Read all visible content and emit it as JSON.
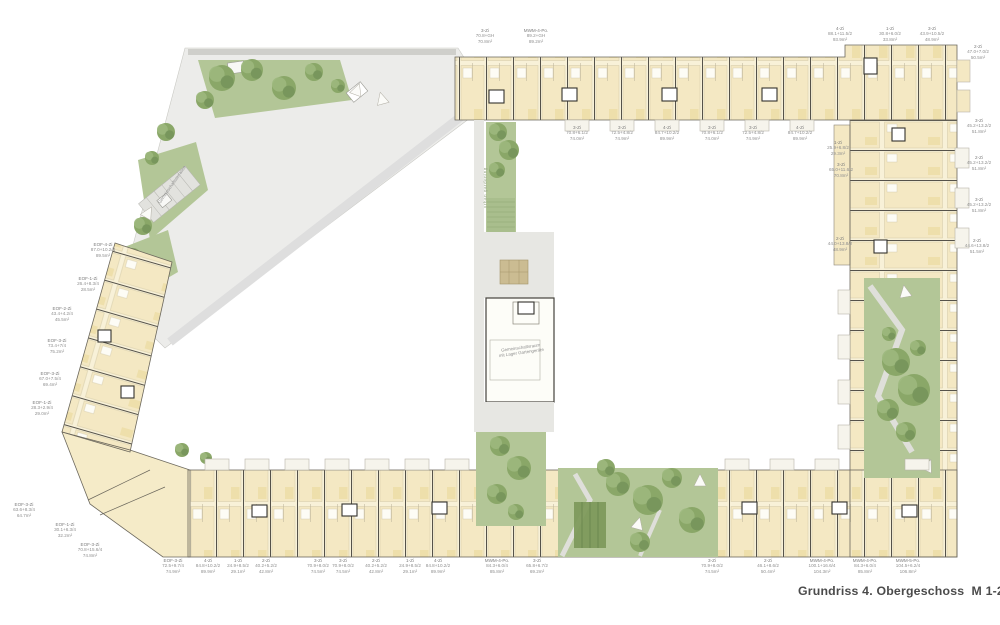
{
  "title": "Grundriss 4. Obergeschoss  M 1-200",
  "colors": {
    "building": "#f8f1d8",
    "unit": "#f4e8c3",
    "wall": "#55524a",
    "path_gray": "#e7e7e3",
    "green": "#b3c697",
    "tree": "#8aa768",
    "label": "#8f8f8f",
    "title_text": "#4b4b4b"
  },
  "annotations": {
    "urban_gardening": "urban gardening",
    "community_room_line1": "Gemeinschaftsraum",
    "community_room_line2": "mit Lager Gartengeräte",
    "terrace": "Gemeinschaftsterrasse"
  },
  "units": [
    {
      "x": 485,
      "y": 28,
      "type": "3-Zi",
      "calc": "70.8+GH",
      "area": "70.8m²"
    },
    {
      "x": 536,
      "y": 28,
      "type": "MWM-4-Po.",
      "calc": "89.2+GH",
      "area": "89.2m²"
    },
    {
      "x": 840,
      "y": 26,
      "type": "4-Zi",
      "calc": "88.1+11.5/2",
      "area": "93.9m²"
    },
    {
      "x": 890,
      "y": 26,
      "type": "1-Zi",
      "calc": "30.8+6.0/2",
      "area": "33.8m²"
    },
    {
      "x": 932,
      "y": 26,
      "type": "3-Zi",
      "calc": "43.9+10.5/2",
      "area": "48.9m²"
    },
    {
      "x": 978,
      "y": 44,
      "type": "2-Zi",
      "calc": "47.0+7.0/2",
      "area": "50.5m²"
    },
    {
      "x": 577,
      "y": 125,
      "type": "3-Zi",
      "calc": "70.8+6.1/2",
      "area": "74.0m²"
    },
    {
      "x": 622,
      "y": 125,
      "type": "3-Zi",
      "calc": "72.5+4.8/2",
      "area": "74.9m²"
    },
    {
      "x": 667,
      "y": 125,
      "type": "4-Zi",
      "calc": "84.7+10.2/2",
      "area": "89.9m²"
    },
    {
      "x": 712,
      "y": 125,
      "type": "3-Zi",
      "calc": "70.8+6.1/2",
      "area": "74.0m²"
    },
    {
      "x": 753,
      "y": 125,
      "type": "3-Zi",
      "calc": "72.5+4.8/2",
      "area": "74.9m²"
    },
    {
      "x": 800,
      "y": 125,
      "type": "4-Zi",
      "calc": "84.7+10.2/2",
      "area": "89.9m²"
    },
    {
      "x": 838,
      "y": 140,
      "type": "1-Zi",
      "calc": "25.9+6.8/2",
      "area": "29.3m²"
    },
    {
      "x": 841,
      "y": 162,
      "type": "3-Zi",
      "calc": "65.0+11.6/2",
      "area": "70.8m²"
    },
    {
      "x": 840,
      "y": 236,
      "type": "2-Zi",
      "calc": "44.0+13.8/2",
      "area": "48.9m²"
    },
    {
      "x": 979,
      "y": 118,
      "type": "3-Zi",
      "calc": "45.2+13.2/2",
      "area": "51.8m²"
    },
    {
      "x": 979,
      "y": 155,
      "type": "2-Zi",
      "calc": "45.2+13.2/2",
      "area": "51.8m²"
    },
    {
      "x": 979,
      "y": 197,
      "type": "3-Zi",
      "calc": "45.2+13.2/2",
      "area": "51.8m²"
    },
    {
      "x": 977,
      "y": 238,
      "type": "2-Zi",
      "calc": "44.6+13.8/2",
      "area": "51.5m²"
    },
    {
      "x": 103,
      "y": 242,
      "type": "EOF-4-Zi",
      "calc": "87.0+10.2/4",
      "area": "89.5m²"
    },
    {
      "x": 88,
      "y": 276,
      "type": "EOF-1-Zi",
      "calc": "26.4+8.3/4",
      "area": "28.5m²"
    },
    {
      "x": 62,
      "y": 306,
      "type": "EOF-2-Zi",
      "calc": "43.4+4.2/4",
      "area": "45.5m²"
    },
    {
      "x": 57,
      "y": 338,
      "type": "EOF-3-Zi",
      "calc": "73.4+7/4",
      "area": "75.2m²"
    },
    {
      "x": 50,
      "y": 371,
      "type": "EOF-3-Zi",
      "calc": "67.0+7.5/4",
      "area": "69.4m²"
    },
    {
      "x": 42,
      "y": 400,
      "type": "EOF-1-Zi",
      "calc": "28.3+2.9/4",
      "area": "29.0m²"
    },
    {
      "x": 24,
      "y": 502,
      "type": "EOF-3-Zi",
      "calc": "63.6+8.3/4",
      "area": "64.7m²"
    },
    {
      "x": 65,
      "y": 522,
      "type": "EOF-1-Zi",
      "calc": "30.1+6.3/4",
      "area": "32.2m²"
    },
    {
      "x": 90,
      "y": 542,
      "type": "EOF-3-Zi",
      "calc": "70.8+15.6/4",
      "area": "74.8m²"
    },
    {
      "x": 173,
      "y": 558,
      "type": "EOF-3-Zi",
      "calc": "72.5+9.7/4",
      "area": "74.9m²"
    },
    {
      "x": 208,
      "y": 558,
      "type": "4-Zi",
      "calc": "84.8+10.2/2",
      "area": "89.9m²"
    },
    {
      "x": 238,
      "y": 558,
      "type": "1-Zi",
      "calc": "24.9+8.5/2",
      "area": "29.1m²"
    },
    {
      "x": 266,
      "y": 558,
      "type": "2-Zi",
      "calc": "40.2+5.2/2",
      "area": "42.8m²"
    },
    {
      "x": 318,
      "y": 558,
      "type": "3-Zi",
      "calc": "70.9+8.0/2",
      "area": "74.5m²"
    },
    {
      "x": 343,
      "y": 558,
      "type": "3-Zi",
      "calc": "70.9+8.0/2",
      "area": "74.5m²"
    },
    {
      "x": 376,
      "y": 558,
      "type": "2-Zi",
      "calc": "40.2+5.2/2",
      "area": "42.8m²"
    },
    {
      "x": 410,
      "y": 558,
      "type": "1-Zi",
      "calc": "24.9+8.5/2",
      "area": "29.1m²"
    },
    {
      "x": 438,
      "y": 558,
      "type": "4-Zi",
      "calc": "84.8+10.2/2",
      "area": "89.9m²"
    },
    {
      "x": 497,
      "y": 558,
      "type": "MWM-4-Po.",
      "calc": "84.3+6.0/4",
      "area": "85.8m²"
    },
    {
      "x": 537,
      "y": 558,
      "type": "3-Zi",
      "calc": "65.8+6.7/2",
      "area": "69.2m²"
    },
    {
      "x": 712,
      "y": 558,
      "type": "3-Zi",
      "calc": "70.9+8.0/2",
      "area": "74.5m²"
    },
    {
      "x": 768,
      "y": 558,
      "type": "2-Zi",
      "calc": "46.1+8.6/2",
      "area": "50.4m²"
    },
    {
      "x": 822,
      "y": 558,
      "type": "MWM-4-Po.",
      "calc": "100.1+16.6/4",
      "area": "104.3m²"
    },
    {
      "x": 865,
      "y": 558,
      "type": "MWM-4-Po.",
      "calc": "84.3+6.0/4",
      "area": "85.8m²"
    },
    {
      "x": 908,
      "y": 558,
      "type": "MWM-5-Po.",
      "calc": "104.5+6.2/4",
      "area": "106.8m²"
    }
  ]
}
